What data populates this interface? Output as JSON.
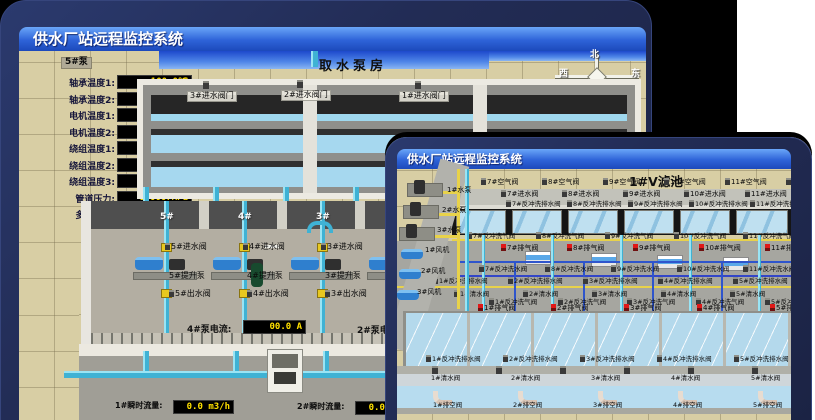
{
  "colors": {
    "page_bg": "#ffffff",
    "backdrop": "#000000",
    "card_navy": "#222c55",
    "titlebar_blue_top": "#6aa6f8",
    "titlebar_blue_bottom": "#1c49bb",
    "value_text_yellow": "#ffe000",
    "value_box_black": "#000000",
    "sand": "#d8cea4",
    "sky_blue": "#1d49cc",
    "water_blue": "#b4d9ec",
    "pipe_cyan": "#3fb2d4",
    "pipe_yellow": "#e8d24a",
    "pipe_blue": "#2f55cc",
    "alarm_red": "#e01818"
  },
  "back_window": {
    "titlebar": "供水厂站远程监控系统",
    "scene_title": "取水泵房",
    "compass": {
      "north": "北",
      "south": "南",
      "east": "东",
      "west": "西"
    },
    "left_panel": {
      "header": "5#泵",
      "labels": [
        "轴承温度1:",
        "轴承温度2:",
        "电机温度1:",
        "电机温度2:",
        "绕组温度1:",
        "绕组温度2:",
        "绕组温度3:",
        "管道压力:",
        "多功能阀:"
      ],
      "values": [
        "100.0℃",
        "100.0℃",
        "18.1℃",
        "17.9℃",
        "18.0℃",
        "18.1℃",
        "18.1℃",
        "0.0007MPa",
        "0%"
      ]
    },
    "right_panel": {
      "header": "1#泵",
      "labels": [
        "轴承温度1",
        "轴承温度2"
      ]
    },
    "inlet_doors": [
      "3#进水阀门",
      "2#进水阀门",
      "1#进水阀门"
    ],
    "pump_hall": {
      "bay_numbers": [
        "5#",
        "4#",
        "3#",
        "2#"
      ],
      "inlet_valves": [
        "5#进水阀",
        "4#进水阀",
        "3#进水阀",
        "2#进水阀"
      ],
      "lift_pumps": [
        "5#提升泵",
        "4#提升泵",
        "3#提升泵",
        "2#提升泵"
      ],
      "outlet_valves": [
        "5#出水阀",
        "4#出水阀",
        "3#出水阀",
        "2#出水阀"
      ]
    },
    "readouts": {
      "pump4_current_label": "4#泵电流:",
      "pump4_current_value": "00.0 A",
      "pump2_current_label": "2#泵电流:",
      "flow1_label": "1#瞬时流量:",
      "flow1_value": "0.0 m3/h",
      "flow2_label": "2#瞬时流量:",
      "flow2_value": "0.0 m3/h"
    }
  },
  "front_window": {
    "titlebar": "供水厂站远程监控系统",
    "scene_title": "1#V滤池",
    "air_valves": [
      "7#空气阀",
      "8#空气阀",
      "9#空气阀",
      "10#空气阀",
      "11#空气阀",
      "12#空气阀"
    ],
    "inlet_valves": [
      "7#进水阀",
      "8#进水阀",
      "9#进水阀",
      "10#进水阀",
      "11#进水阀",
      "12#进水阀"
    ],
    "backwash_drain_valves_upper": [
      "7#反冲洗排水阀",
      "8#反冲洗排水阀",
      "9#反冲洗排水阀",
      "10#反冲洗排水阀",
      "11#反冲洗排水阀",
      "12#反冲洗排水阀"
    ],
    "backwash_air_valves_upper": [
      "7#反冲洗气阀",
      "8#反冲洗气阀",
      "9#反冲洗气阀",
      "10#反冲洗气阀",
      "11#反冲洗气阀",
      "12#反冲洗气阀"
    ],
    "exhaust_valves_upper": [
      "7#排气阀",
      "8#排气阀",
      "9#排气阀",
      "10#排气阀",
      "11#排气阀",
      "12#排气阀"
    ],
    "backwash_water_valves_upper": [
      "7#反冲洗水阀",
      "8#反冲洗水阀",
      "9#反冲洗水阀",
      "10#反冲洗水阀",
      "11#反冲洗水阀",
      "12#反冲洗水阀"
    ],
    "backwash_drain_valves_mid": [
      "1#反冲洗排水阀",
      "2#反冲洗排水阀",
      "3#反冲洗排水阀",
      "4#反冲洗排水阀",
      "5#反冲洗排水阀",
      "6#反冲洗排水阀"
    ],
    "clean_water_valves_mid": [
      "1#清水阀",
      "2#清水阀",
      "3#清水阀",
      "4#清水阀",
      "5#清水阀",
      "6#清水阀"
    ],
    "backwash_air_valves_lower": [
      "1#反冲洗气阀",
      "2#反冲洗气阀",
      "3#反冲洗气阀",
      "4#反冲洗气阀",
      "5#反冲洗气阀",
      "6#反冲洗气阀"
    ],
    "exhaust_valves_lower": [
      "1#排气阀",
      "2#排气阀",
      "3#排气阀",
      "4#排气阀",
      "5#排气阀",
      "6#排气阀"
    ],
    "backwash_drain_valves_lower": [
      "1#反冲洗排水阀",
      "2#反冲洗排水阀",
      "3#反冲洗排水阀",
      "4#反冲洗排水阀",
      "5#反冲洗排水阀",
      "6#反冲洗排水阀"
    ],
    "clean_water_valves_lower": [
      "1#清水阀",
      "2#清水阀",
      "3#清水阀",
      "4#清水阀",
      "5#清水阀",
      "6#清水阀"
    ],
    "empty_valves": [
      "1#排空阀",
      "2#排空阀",
      "3#排空阀",
      "4#排空阀",
      "5#排空阀",
      "6#排空阀"
    ],
    "wash_pumps": [
      "1#水泵",
      "2#水泵",
      "3#水泵"
    ],
    "blowers": [
      "1#风机",
      "2#风机",
      "3#风机"
    ]
  }
}
